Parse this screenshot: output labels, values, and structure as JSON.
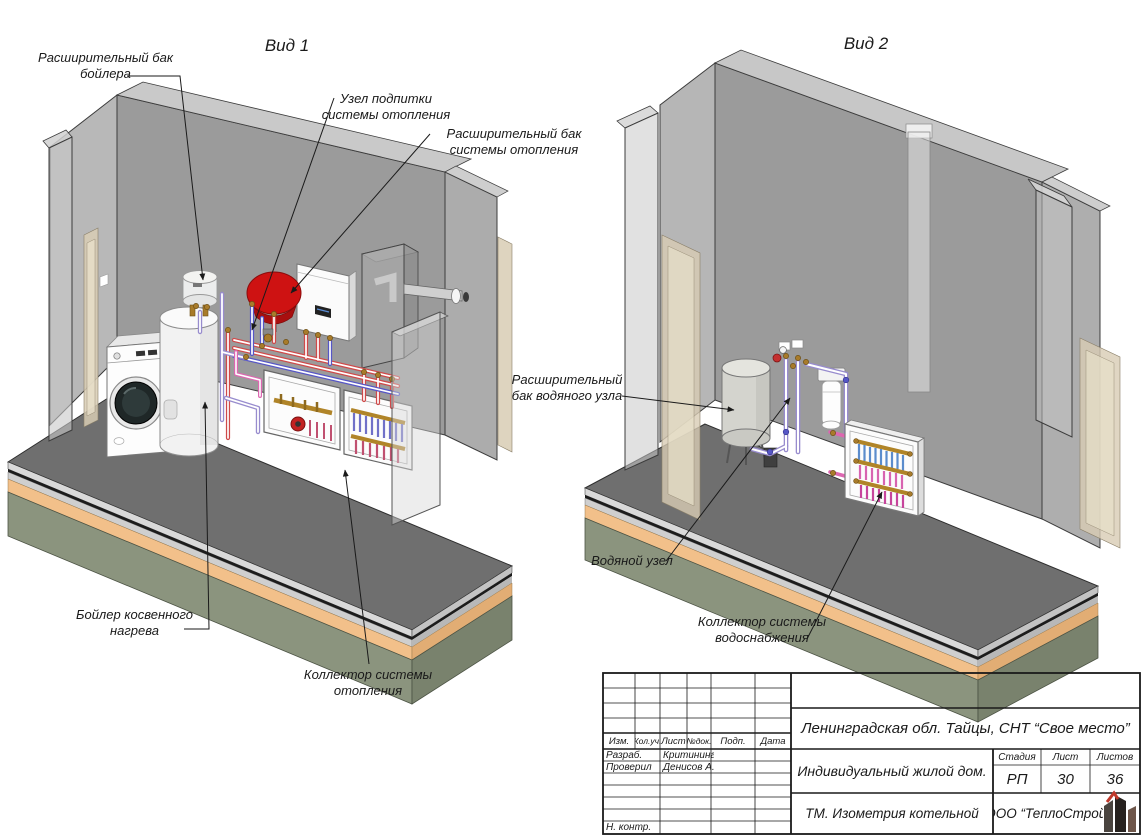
{
  "sheet": {
    "views": [
      {
        "title": "Вид 1"
      },
      {
        "title": "Вид 2"
      }
    ]
  },
  "callouts": {
    "boiler_expansion_tank": {
      "lines": [
        "Расширительный бак",
        "бойлера"
      ]
    },
    "makeup_unit": {
      "lines": [
        "Узел подпитки",
        "системы отопления"
      ]
    },
    "heating_expansion_tank": {
      "lines": [
        "Расширительный бак",
        "системы отопления"
      ]
    },
    "indirect_boiler": {
      "lines": [
        "Бойлер косвенного",
        "нагрева"
      ]
    },
    "heating_manifold": {
      "lines": [
        "Коллектор системы",
        "отопления"
      ]
    },
    "water_unit_expansion_tank": {
      "lines": [
        "Расширительный",
        "бак водяного узла"
      ]
    },
    "water_unit": {
      "lines": [
        "Водяной узел"
      ]
    },
    "water_supply_manifold": {
      "lines": [
        "Коллектор системы",
        "водоснабжения"
      ]
    }
  },
  "title_block": {
    "revision_headers": [
      "Изм.",
      "Кол.уч.",
      "Лист",
      "№док.",
      "Подп.",
      "Дата"
    ],
    "rows": [
      {
        "role": "Разраб.",
        "name": "Критинина"
      },
      {
        "role": "Проверил",
        "name": "Денисов А."
      }
    ],
    "ncontr_label": "Н. контр.",
    "project": "Ленинградская обл. Тайцы, СНТ “Свое место”",
    "object": "Индивидуальный жилой дом.",
    "stage_label": "Стадия",
    "sheet_label": "Лист",
    "sheets_label": "Листов",
    "stage": "РП",
    "sheet_no": "30",
    "sheets_total": "36",
    "doc_title": "ТМ. Изометрия котельной",
    "company": "ООО “ТеплоСтрой”"
  },
  "icons": {
    "logo": "buildings-icon"
  },
  "colors": {
    "leader": "#1a1a1a",
    "wall_gray": "#9b9b9b",
    "floor_gray": "#6f6f6f",
    "slab_orange": "#f2c08a",
    "slab_olive": "#8b947e",
    "door_beige": "#d8ccb4",
    "tank_red": "#ce1212",
    "pipe_red": "#cf4a4a",
    "pipe_blue": "#5656c6",
    "pipe_lavender": "#988cce",
    "pipe_pink": "#dd67b1",
    "brass": "#a87b2a",
    "logo_red": "#c0392b"
  }
}
